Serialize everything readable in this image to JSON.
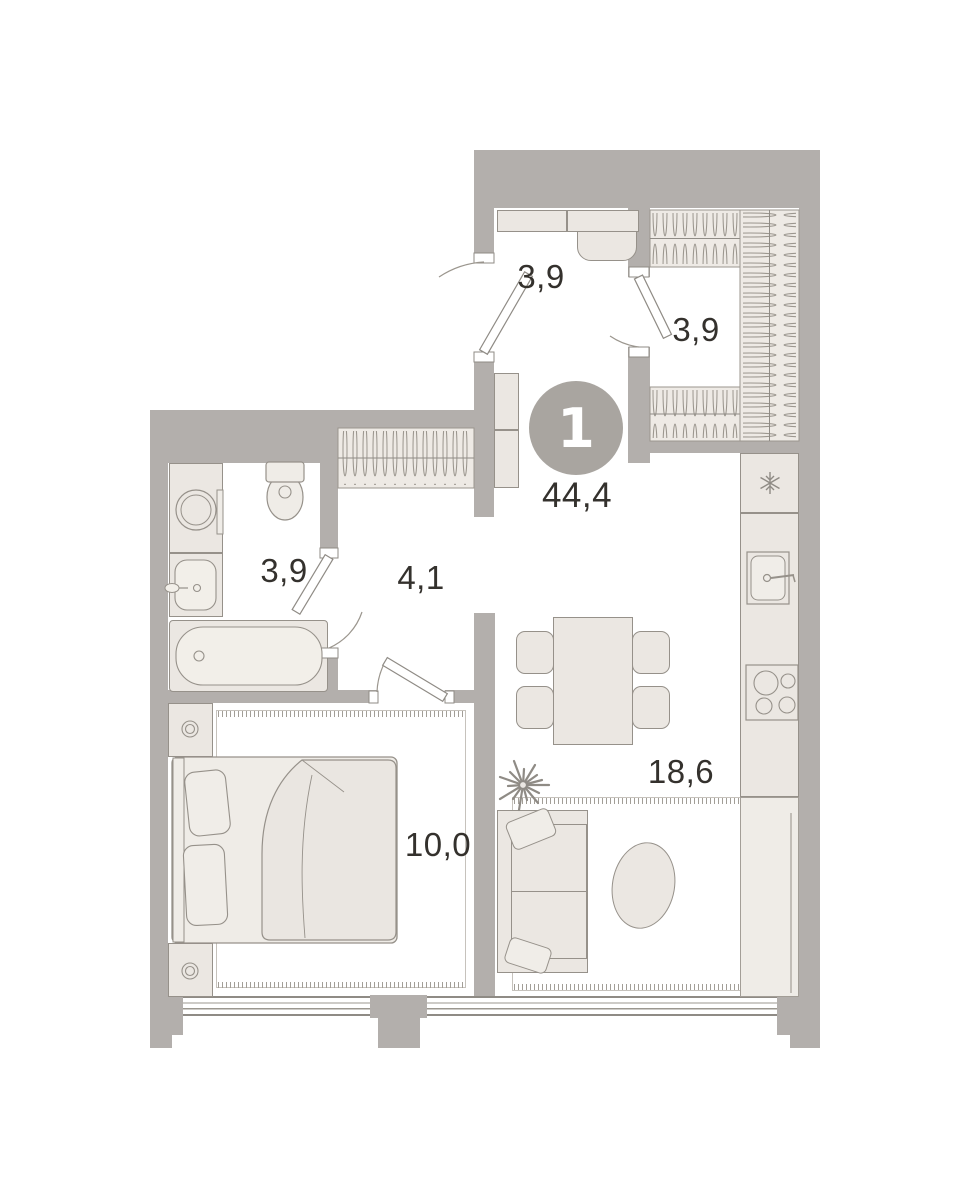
{
  "floor_plan": {
    "badge": {
      "number": "1",
      "total_area": "44,4"
    },
    "rooms": {
      "hallway": {
        "area": "3,9"
      },
      "wardrobe": {
        "area": "3,9"
      },
      "bathroom": {
        "area": "3,9"
      },
      "corridor": {
        "area": "4,1"
      },
      "bedroom": {
        "area": "10,0"
      },
      "living_kitchen": {
        "area": "18,6"
      }
    },
    "icons": {
      "fridge": "snowflake-icon",
      "wardrobe_rails": "clothes-hanger-icon",
      "stove": "four-burner-stove-icon",
      "plant": "plant-icon"
    },
    "colors": {
      "wall": "#b3afac",
      "furniture_fill": "#ebe7e2",
      "furniture_stroke": "#96918a",
      "floor": "#ffffff",
      "badge_circle": "#a9a5a0",
      "label_text": "#34312d"
    }
  }
}
